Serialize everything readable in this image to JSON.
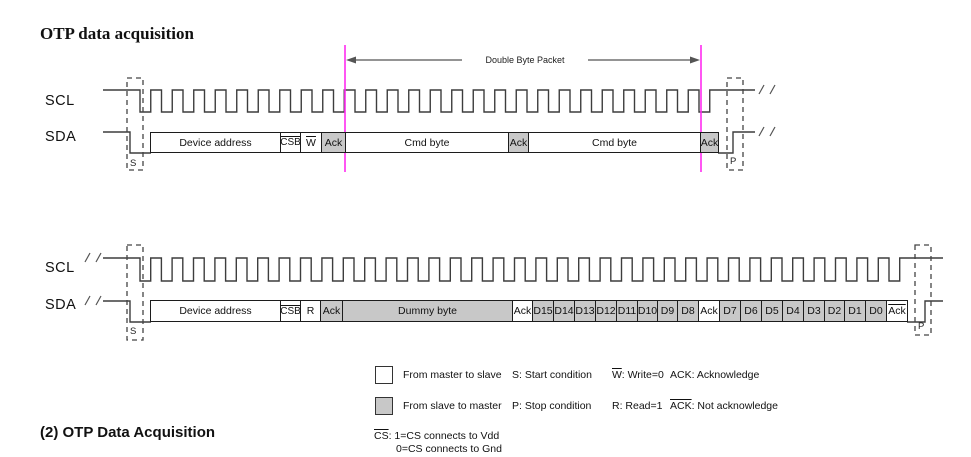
{
  "page": {
    "title": "OTP data acquisition",
    "caption": "(2) OTP Data Acquisition"
  },
  "diagram1": {
    "scl_label": "SCL",
    "sda_label": "SDA",
    "start_marker": "S",
    "stop_marker": "P",
    "packet_label": "Double Byte Packet",
    "boundary_color": "#ff2bf0",
    "segments": [
      {
        "label": "Device address",
        "from": "master",
        "overline": false
      },
      {
        "label": "CSB",
        "from": "master",
        "overline": true
      },
      {
        "label": "W",
        "from": "master",
        "overline": true
      },
      {
        "label": "Ack",
        "from": "slave",
        "overline": false
      },
      {
        "label": "Cmd byte",
        "from": "master",
        "overline": false
      },
      {
        "label": "Ack",
        "from": "slave",
        "overline": false
      },
      {
        "label": "Cmd byte",
        "from": "master",
        "overline": false
      },
      {
        "label": "Ack",
        "from": "slave",
        "overline": false
      }
    ]
  },
  "diagram2": {
    "scl_label": "SCL",
    "sda_label": "SDA",
    "start_marker": "S",
    "stop_marker": "P",
    "segments": [
      {
        "label": "Device address",
        "from": "master",
        "overline": false
      },
      {
        "label": "CSB",
        "from": "master",
        "overline": true
      },
      {
        "label": "R",
        "from": "master",
        "overline": false
      },
      {
        "label": "Ack",
        "from": "slave",
        "overline": false
      },
      {
        "label": "Dummy byte",
        "from": "slave",
        "overline": false
      },
      {
        "label": "Ack",
        "from": "master",
        "overline": false
      },
      {
        "label": "D15",
        "from": "slave",
        "overline": false
      },
      {
        "label": "D14",
        "from": "slave",
        "overline": false
      },
      {
        "label": "D13",
        "from": "slave",
        "overline": false
      },
      {
        "label": "D12",
        "from": "slave",
        "overline": false
      },
      {
        "label": "D11",
        "from": "slave",
        "overline": false
      },
      {
        "label": "D10",
        "from": "slave",
        "overline": false
      },
      {
        "label": "D9",
        "from": "slave",
        "overline": false
      },
      {
        "label": "D8",
        "from": "slave",
        "overline": false
      },
      {
        "label": "Ack",
        "from": "master",
        "overline": false
      },
      {
        "label": "D7",
        "from": "slave",
        "overline": false
      },
      {
        "label": "D6",
        "from": "slave",
        "overline": false
      },
      {
        "label": "D5",
        "from": "slave",
        "overline": false
      },
      {
        "label": "D4",
        "from": "slave",
        "overline": false
      },
      {
        "label": "D3",
        "from": "slave",
        "overline": false
      },
      {
        "label": "D2",
        "from": "slave",
        "overline": false
      },
      {
        "label": "D1",
        "from": "slave",
        "overline": false
      },
      {
        "label": "D0",
        "from": "slave",
        "overline": false
      },
      {
        "label": "Ack",
        "from": "master",
        "overline": true
      }
    ]
  },
  "legend": {
    "master_label": "From master to slave",
    "slave_label": "From slave to master",
    "start": "S: Start condition",
    "stop": "P: Stop condition",
    "write_term": "W",
    "write_rest": ": Write=0",
    "read": "R: Read=1",
    "ack": "ACK: Acknowledge",
    "nack_term": "ACK",
    "nack_rest": ": Not acknowledge",
    "cs_term": "CS",
    "cs_rest": ": 1=CS connects to Vdd",
    "cs_line2": "0=CS connects to Gnd",
    "master_fill": "#ffffff",
    "slave_fill": "#c8c8c8"
  }
}
